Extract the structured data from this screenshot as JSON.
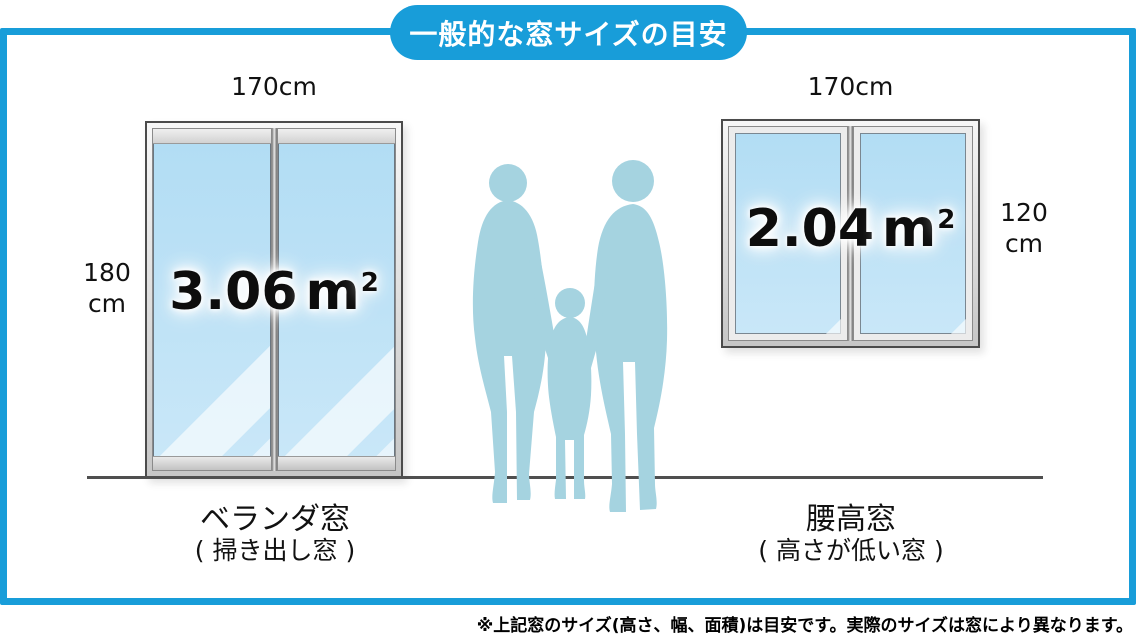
{
  "title": "一般的な窓サイズの目安",
  "footnote": "※上記窓のサイズ(高さ、幅、面積)は目安です。実際のサイズは窓により異なります。",
  "colors": {
    "accent": "#189DD9",
    "glass": "#C9E7F8",
    "silhouette": "#A5D3E0",
    "frame": "#4B4B4B"
  },
  "left_window": {
    "width_label": "170cm",
    "height_value": "180",
    "height_unit": "cm",
    "area_value": "3.06",
    "area_unit": "m",
    "area_sup": "2",
    "caption": "ベランダ窓",
    "subcaption": "( 掃き出し窓 )"
  },
  "right_window": {
    "width_label": "170cm",
    "height_value": "120",
    "height_unit": "cm",
    "area_value": "2.04",
    "area_unit": "m",
    "area_sup": "2",
    "caption": "腰高窓",
    "subcaption": "( 高さが低い窓 )"
  }
}
